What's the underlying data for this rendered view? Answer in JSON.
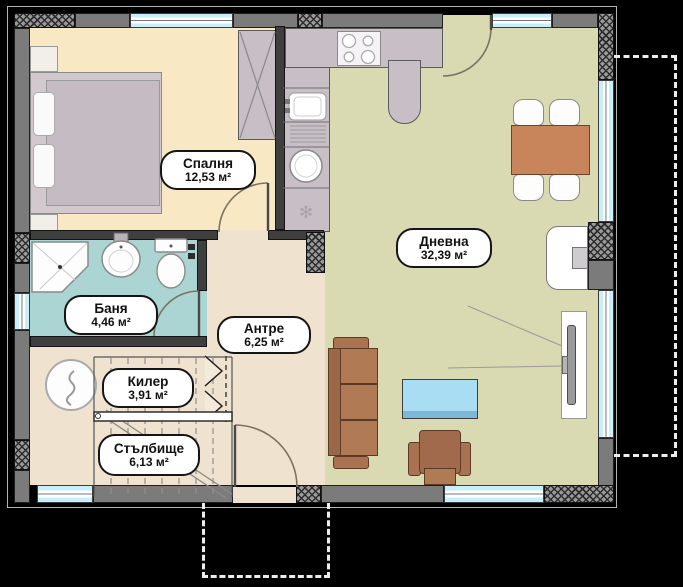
{
  "plan": {
    "type": "apartment-floor-plan",
    "language": "bg",
    "rooms": [
      {
        "id": "bedroom",
        "name": "Спалня",
        "area": "12,53 м²"
      },
      {
        "id": "living",
        "name": "Дневна",
        "area": "32,39 м²"
      },
      {
        "id": "bathroom",
        "name": "Баня",
        "area": "4,46 м²"
      },
      {
        "id": "hallway",
        "name": "Антре",
        "area": "6,25 м²"
      },
      {
        "id": "closet",
        "name": "Килер",
        "area": "3,91 м²"
      },
      {
        "id": "staircase",
        "name": "Стълбище",
        "area": "6,13 м²"
      }
    ],
    "colors": {
      "background": "#000000",
      "bedroom_floor": "#f8e9c4",
      "living_floor": "#d9d9b2",
      "hall_floor": "#efe2cf",
      "bath_floor": "#abd5d3",
      "wall": "#7b7b7b",
      "window": "#c9eefb",
      "furniture_wood": "#b07a55",
      "counter": "#c7bec6",
      "coffee_table": "#a9ddf4"
    }
  }
}
